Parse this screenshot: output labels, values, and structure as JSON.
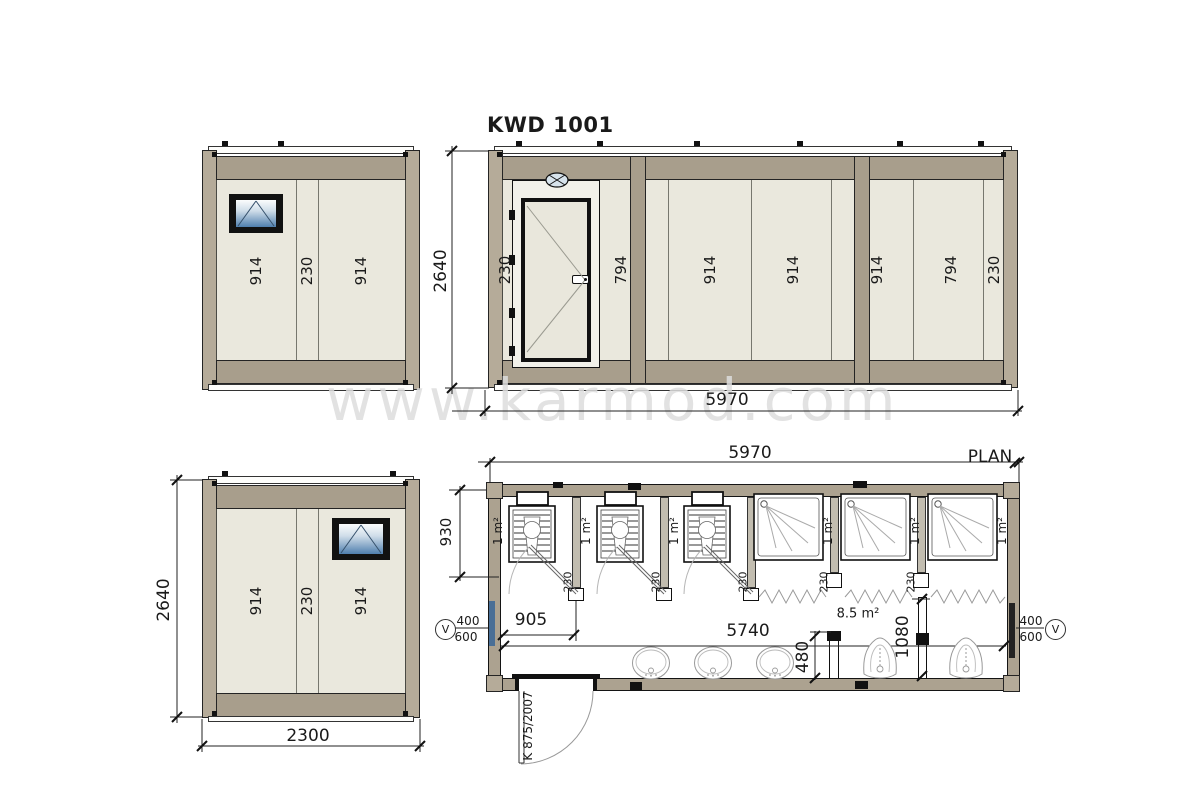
{
  "title": "KWD 1001",
  "watermark_text": "www.karmod.com",
  "colors": {
    "frame": "#a89e8c",
    "panel": "#eae8dd",
    "glass": "#4f7fae"
  },
  "views": {
    "front_elevation": {
      "panel_labels": [
        "914",
        "230",
        "914"
      ]
    },
    "side_elevation": {
      "panel_labels": [
        "230",
        "794",
        "914",
        "914",
        "914",
        "794",
        "230"
      ],
      "height_dim": "2640",
      "length_dim": "5970"
    },
    "rear_elevation": {
      "panel_labels": [
        "914",
        "230",
        "914"
      ],
      "height_dim": "2640",
      "width_dim": "2300"
    },
    "plan": {
      "label": "PLAN",
      "length_dim": "5970",
      "interior_length_dim": "5740",
      "wc_depth_dim": "930",
      "first_cubicle_dim": "905",
      "urinal_screen_dim": "480",
      "urinal_wall_dim": "1080",
      "partition_thickness": "230",
      "cubicle_area": "1 m²",
      "hall_area": "8.5 m²",
      "window_width": "400",
      "window_height": "600",
      "window_symbol": "V",
      "door_code": "K 875/2007"
    }
  }
}
